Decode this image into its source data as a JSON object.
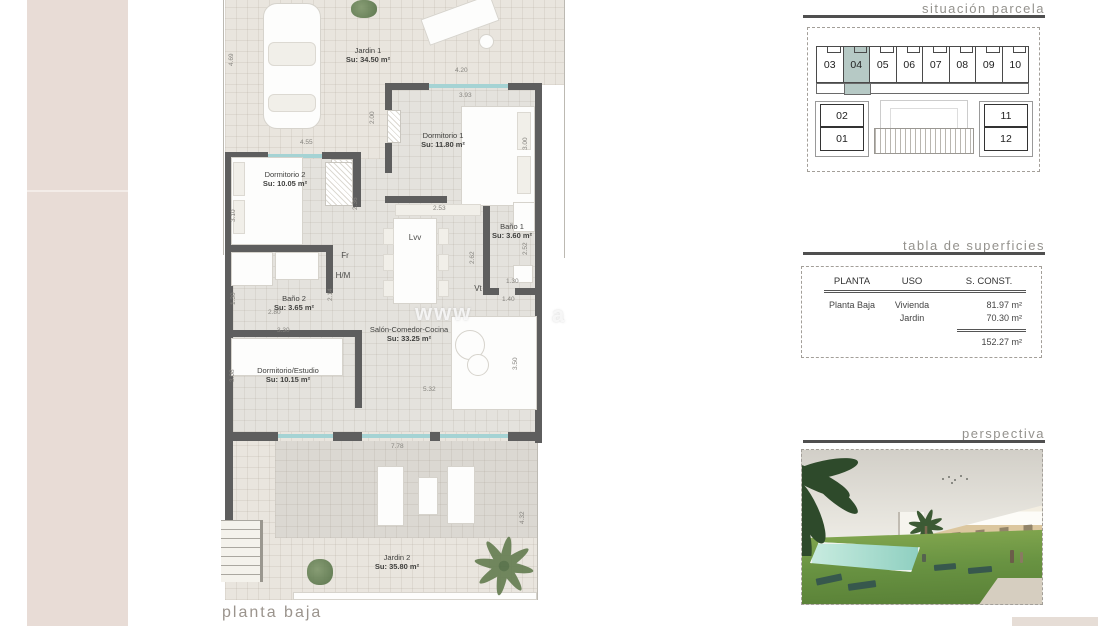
{
  "page": {
    "footer_label": "planta baja",
    "watermark": "www",
    "watermark_tail": "a"
  },
  "plan": {
    "rooms": [
      {
        "name": "Jardin 1",
        "area": "Su: 34.50 m²"
      },
      {
        "name": "Dormitorio 1",
        "area": "Su: 11.80 m²"
      },
      {
        "name": "Dormitorio 2",
        "area": "Su: 10.05 m²"
      },
      {
        "name": "Baño 1",
        "area": "Su: 3.60 m²"
      },
      {
        "name": "Baño 2",
        "area": "Su: 3.65 m²"
      },
      {
        "name": "Salón-Comedor-Cocina",
        "area": "Su: 33.25 m²"
      },
      {
        "name": "Dormitorio/Estudio",
        "area": "Su: 10.15 m²"
      },
      {
        "name": "Jardin 2",
        "area": "Su: 35.80 m²"
      }
    ],
    "fixtures": [
      "Lvv",
      "Fr",
      "H/M",
      "Vt"
    ],
    "dims": [
      "4.69",
      "4.20",
      "3.93",
      "2.00",
      "3.00",
      "4.55",
      "3.10",
      "2.36",
      "2.53",
      "2.62",
      "2.52",
      "1.30",
      "1.40",
      "1.30",
      "2.80",
      "2.14",
      "3.30",
      "3.08",
      "3.50",
      "5.32",
      "7.78",
      "4.32"
    ]
  },
  "sections": {
    "situacion": {
      "title": "situación parcela",
      "units_top": [
        "03",
        "04",
        "05",
        "06",
        "07",
        "08",
        "09",
        "10"
      ],
      "highlighted_unit": "04",
      "units_left": [
        "02",
        "01"
      ],
      "units_right": [
        "11",
        "12"
      ]
    },
    "tabla": {
      "title": "tabla de superficies",
      "headers": [
        "PLANTA",
        "USO",
        "S. CONST."
      ],
      "rows": [
        {
          "planta": "Planta Baja",
          "uso": "Vivienda",
          "sconst": "81.97 m²"
        },
        {
          "planta": "",
          "uso": "Jardin",
          "sconst": "70.30 m²"
        }
      ],
      "total": "152.27 m²"
    },
    "perspectiva": {
      "title": "perspectiva"
    }
  },
  "colors": {
    "highlight_unit": "#b6c9c5",
    "wall": "#5e5e5e",
    "window": "#a5d3d4",
    "stripe": "#e8dcd6",
    "section_bar": "#4f4f4f"
  }
}
